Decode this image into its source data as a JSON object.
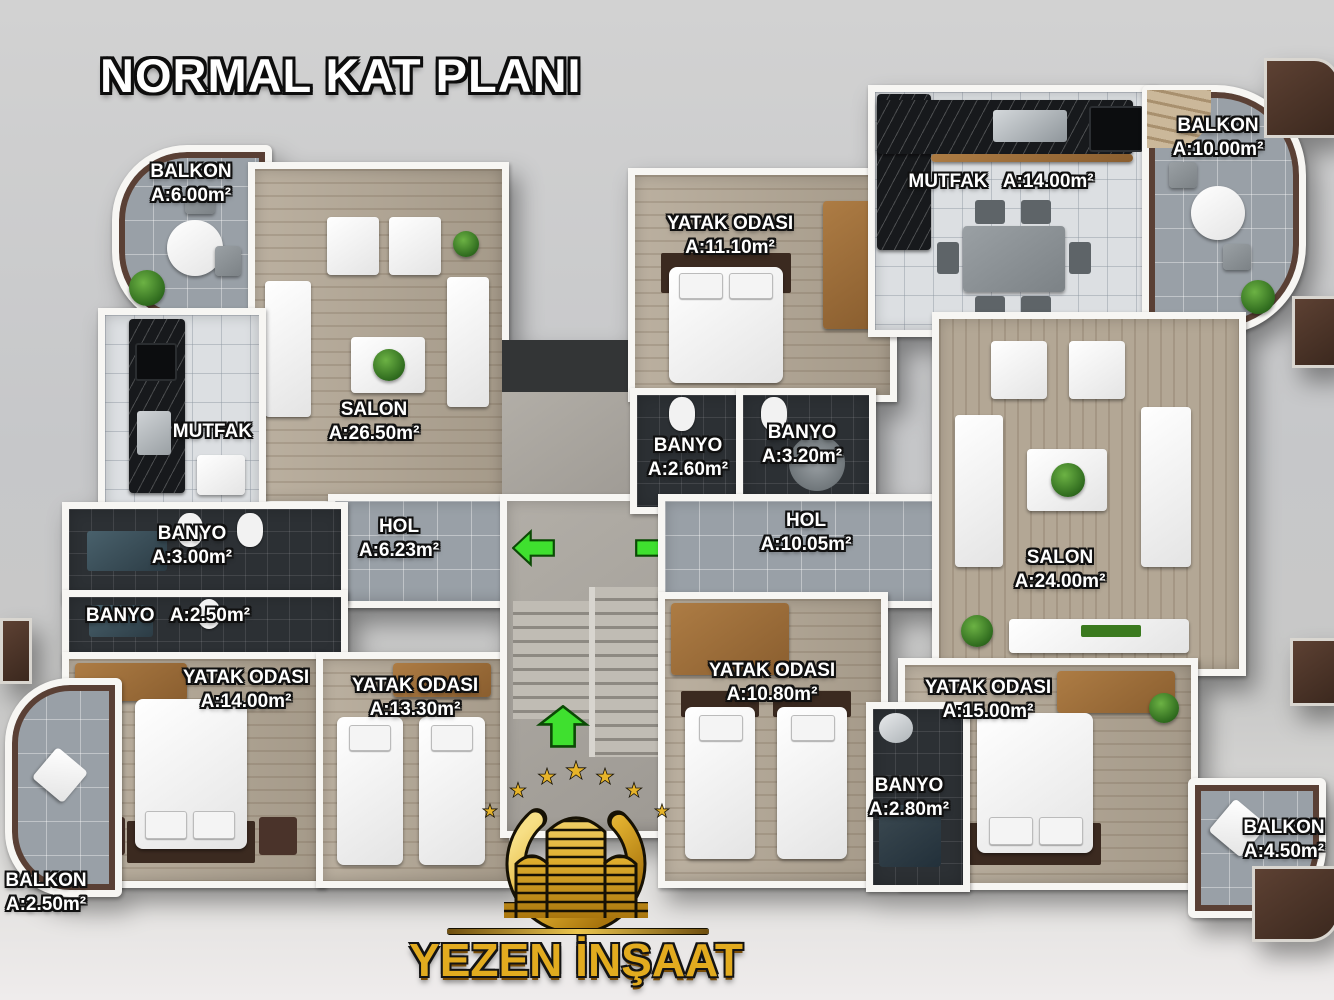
{
  "title": "NORMAL KAT PLANI",
  "rooms": {
    "balkon_top_left": {
      "name": "BALKON",
      "area": "A:6.00m²"
    },
    "salon_left": {
      "name": "SALON",
      "area": "A:26.50m²"
    },
    "mutfak_left": {
      "name": "MUTFAK",
      "area": ""
    },
    "hol_left": {
      "name": "HOL",
      "area": "A:6.23m²"
    },
    "banyo_300": {
      "name": "BANYO",
      "area": "A:3.00m²"
    },
    "banyo_250": {
      "name": "BANYO",
      "area": "A:2.50m²"
    },
    "yatak_1400": {
      "name": "YATAK ODASI",
      "area": "A:14.00m²"
    },
    "yatak_1330": {
      "name": "YATAK ODASI",
      "area": "A:13.30m²"
    },
    "balkon_bottom_left": {
      "name": "BALKON",
      "area": "A:2.50m²"
    },
    "yatak_1110": {
      "name": "YATAK ODASI",
      "area": "A:11.10m²"
    },
    "banyo_260": {
      "name": "BANYO",
      "area": "A:2.60m²"
    },
    "banyo_320": {
      "name": "BANYO",
      "area": "A:3.20m²"
    },
    "hol_right": {
      "name": "HOL",
      "area": "A:10.05m²"
    },
    "mutfak_right": {
      "name": "MUTFAK",
      "area": "A:14.00m²"
    },
    "balkon_top_right": {
      "name": "BALKON",
      "area": "A:10.00m²"
    },
    "salon_right": {
      "name": "SALON",
      "area": "A:24.00m²"
    },
    "yatak_1080": {
      "name": "YATAK ODASI",
      "area": "A:10.80m²"
    },
    "yatak_1500": {
      "name": "YATAK ODASI",
      "area": "A:15.00m²"
    },
    "banyo_280": {
      "name": "BANYO",
      "area": "A:2.80m²"
    },
    "balkon_bottom_right": {
      "name": "BALKON",
      "area": "A:4.50m²"
    }
  },
  "logo": {
    "company": "YEZEN İNŞAAT",
    "star_glyph": "★"
  },
  "colors": {
    "arrow_green": "#3fe02f",
    "logo_gold": "#e2ab1f",
    "wall_white": "#f7f6f3"
  }
}
